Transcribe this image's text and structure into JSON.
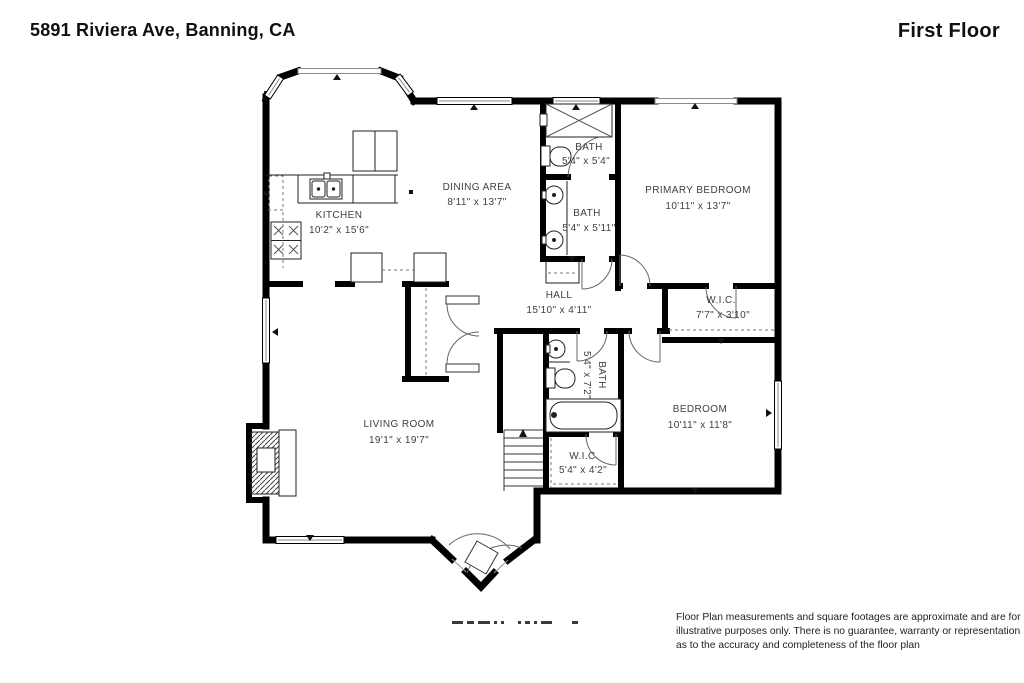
{
  "header": {
    "address": "5891 Riviera Ave, Banning, CA",
    "floor_label": "First Floor"
  },
  "rooms": [
    {
      "id": "kitchen",
      "name": "KITCHEN",
      "dims": "10'2\" x 15'6\""
    },
    {
      "id": "dining-area",
      "name": "DINING AREA",
      "dims": "8'11\" x 13'7\""
    },
    {
      "id": "bath-top",
      "name": "BATH",
      "dims": "5'4\" x 5'4\""
    },
    {
      "id": "bath-middle",
      "name": "BATH",
      "dims": "5'4\" x 5'11\""
    },
    {
      "id": "primary-bedroom",
      "name": "PRIMARY BEDROOM",
      "dims": "10'11\" x 13'7\""
    },
    {
      "id": "hall",
      "name": "HALL",
      "dims": "15'10\" x 4'11\""
    },
    {
      "id": "wic-primary",
      "name": "W.I.C.",
      "dims": "7'7\" x 3'10\""
    },
    {
      "id": "bath-hall",
      "name": "BATH",
      "dims": "5'4\" x 7'2\""
    },
    {
      "id": "bedroom",
      "name": "BEDROOM",
      "dims": "10'11\" x 11'8\""
    },
    {
      "id": "wic-hall",
      "name": "W.I.C.",
      "dims": "5'4\" x 4'2\""
    },
    {
      "id": "living-room",
      "name": "LIVING ROOM",
      "dims": "19'1\" x 19'7\""
    }
  ],
  "disclaimer": "Floor Plan measurements and square footages are approximate and are for illustrative purposes only. There is no guarantee, warranty or representation as to the accuracy and completeness of the floor plan",
  "colors": {
    "wall": "#000000",
    "label_text": "#3f3f3f",
    "window_line": "#8a8a8a"
  }
}
